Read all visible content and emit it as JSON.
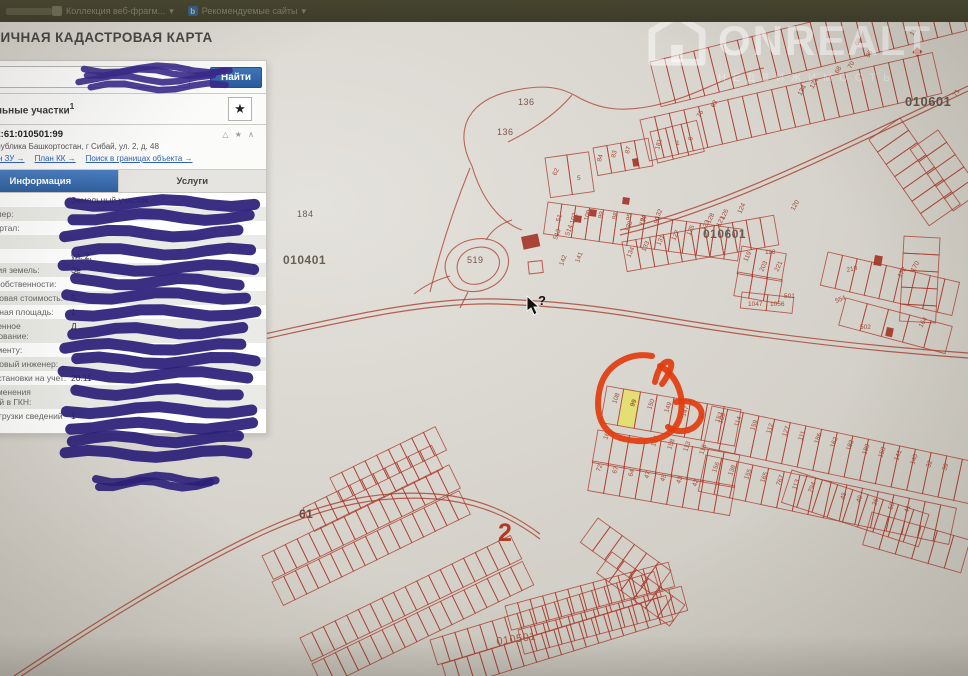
{
  "browser_bar": {
    "item1": "Коллекция веб-фрагм...",
    "item1_arrow": "▾",
    "item2": "Рекомендуемые сайты",
    "item2_arrow": "▾",
    "b_icon": "b"
  },
  "header": {
    "title": "ПУБЛИЧНАЯ КАДАСТРОВАЯ КАРТА"
  },
  "search": {
    "find_button": "Найти",
    "clear_icon": "×"
  },
  "results": {
    "group_label": "Земельные участки",
    "group_sup": "1",
    "star_icon": "★"
  },
  "parcel": {
    "index": "1.",
    "cadastral_number": "02:61:010501:99",
    "header_icons": "△ ★ ∧",
    "address": "Республика Башкортостан, г Сибай, ул. 2, д. 48",
    "links": [
      "План ЗУ →",
      "План КК →",
      "Поиск в границах объекта →"
    ],
    "tabs": {
      "info": "Информация",
      "services": "Услуги"
    },
    "fields": [
      {
        "label": "Тип:",
        "value": "Земельный участок"
      },
      {
        "label": "Кад. номер:",
        "value": ""
      },
      {
        "label": "Кад. квартал:",
        "value": ""
      },
      {
        "label": "Статус:",
        "value": ""
      },
      {
        "label": "Адрес:",
        "value": "ул. 2,"
      },
      {
        "label": "Категория земель:",
        "value": "Зе"
      },
      {
        "label": "Форма собственности:",
        "value": ""
      },
      {
        "label": "Кадастровая стоимость:",
        "value": "5"
      },
      {
        "label": "Уточненная площадь:",
        "value": "1"
      },
      {
        "label": "Разрешенное использование:",
        "value": "Д"
      },
      {
        "label": "по документу:",
        "value": ""
      },
      {
        "label": "Кадастровый инженер:",
        "value": ""
      },
      {
        "label": "Дата постановки на учет:",
        "value": "20.11"
      },
      {
        "label": "Дата изменения сведений в ГКН:",
        "value": ""
      },
      {
        "label": "Дата выгрузки сведений из ГКН:",
        "value": "1"
      }
    ]
  },
  "watermark": {
    "brand": "ONREALT",
    "sub": "НЕДВИЖИМОСТЬ"
  },
  "colors": {
    "accent_blue": "#2f5f9e",
    "pen_purple": "#2b1f78",
    "annotation_red": "#e23c0e",
    "highlight_yellow": "#e6e06b",
    "map_line_red": "#ac3a2c"
  },
  "map": {
    "cursor": {
      "x": 527,
      "y": 296,
      "glyph": "?"
    },
    "selected_parcel": {
      "number": "99"
    },
    "area_labels": [
      {
        "t": "010601",
        "x": 905,
        "y": 106,
        "s": 13,
        "c": "#5f564d",
        "b": 1
      },
      {
        "t": "010601",
        "x": 703,
        "y": 238,
        "s": 12,
        "c": "#6a5f55",
        "b": 1
      },
      {
        "t": "010401",
        "x": 283,
        "y": 264,
        "s": 12,
        "c": "#6a5f55",
        "b": 1
      },
      {
        "t": "184",
        "x": 297,
        "y": 217,
        "s": 9,
        "c": "#6a5f55"
      },
      {
        "t": "136",
        "x": 518,
        "y": 105,
        "s": 9,
        "c": "#7d5348"
      },
      {
        "t": "136",
        "x": 497,
        "y": 135,
        "s": 9,
        "c": "#7d5348"
      },
      {
        "t": "519",
        "x": 467,
        "y": 263,
        "s": 9,
        "c": "#7d5348"
      },
      {
        "t": "61",
        "x": 299,
        "y": 518,
        "s": 12,
        "c": "#6e4a3e",
        "b": 1
      },
      {
        "t": "2",
        "x": 498,
        "y": 541,
        "s": 25,
        "c": "#b03a24",
        "b": 1
      },
      {
        "t": "010501",
        "x": 497,
        "y": 645,
        "s": 11,
        "c": "#a85a43",
        "r": -8
      }
    ],
    "rows": [
      {
        "x": 650,
        "y": 62,
        "a": -14,
        "n": 21,
        "w": 15,
        "h": 46
      },
      {
        "x": 640,
        "y": 120,
        "a": -13,
        "n": 20,
        "w": 15,
        "h": 42
      },
      {
        "x": 593,
        "y": 148,
        "a": -10,
        "n": 4,
        "w": 14,
        "h": 28
      },
      {
        "x": 650,
        "y": 132,
        "a": -14,
        "n": 3,
        "w": 16,
        "h": 32
      },
      {
        "x": 548,
        "y": 202,
        "a": 8,
        "n": 14,
        "w": 14,
        "h": 32
      },
      {
        "x": 622,
        "y": 242,
        "a": -10,
        "n": 11,
        "w": 14,
        "h": 30
      },
      {
        "x": 742,
        "y": 246,
        "a": 10,
        "n": 3,
        "w": 15,
        "h": 28
      },
      {
        "x": 738,
        "y": 272,
        "a": 10,
        "n": 3,
        "w": 15,
        "h": 24
      },
      {
        "x": 828,
        "y": 252,
        "a": 13,
        "n": 9,
        "w": 15,
        "h": 34
      },
      {
        "x": 846,
        "y": 298,
        "a": 15,
        "n": 5,
        "w": 22,
        "h": 28
      },
      {
        "x": 940,
        "y": 238,
        "a": 93,
        "n": 5,
        "w": 17,
        "h": 36
      },
      {
        "x": 900,
        "y": 118,
        "a": 55,
        "n": 7,
        "w": 15,
        "h": 38
      },
      {
        "x": 938,
        "y": 130,
        "a": 55,
        "n": 5,
        "w": 15,
        "h": 34
      },
      {
        "x": 742,
        "y": 292,
        "a": 6,
        "n": 2,
        "w": 26,
        "h": 16
      },
      {
        "x": 607,
        "y": 386,
        "a": 10,
        "n": 8,
        "w": 17,
        "h": 37,
        "hl": 1
      },
      {
        "x": 598,
        "y": 430,
        "a": 10,
        "n": 9,
        "w": 16,
        "h": 33
      },
      {
        "x": 593,
        "y": 461,
        "a": 10,
        "n": 9,
        "w": 16,
        "h": 30
      },
      {
        "x": 712,
        "y": 406,
        "a": 12,
        "n": 17,
        "w": 16,
        "h": 42
      },
      {
        "x": 706,
        "y": 455,
        "a": 12,
        "n": 16,
        "w": 16,
        "h": 37
      },
      {
        "x": 598,
        "y": 518,
        "a": 36,
        "n": 6,
        "w": 15,
        "h": 30
      },
      {
        "x": 612,
        "y": 552,
        "a": 36,
        "n": 6,
        "w": 15,
        "h": 26
      },
      {
        "x": 792,
        "y": 470,
        "a": 18,
        "n": 9,
        "w": 16,
        "h": 34
      },
      {
        "x": 872,
        "y": 512,
        "a": 16,
        "n": 6,
        "w": 17,
        "h": 34
      },
      {
        "x": 330,
        "y": 478,
        "a": -26,
        "n": 9,
        "w": 13,
        "h": 26
      },
      {
        "x": 303,
        "y": 508,
        "a": -26,
        "n": 11,
        "w": 13,
        "h": 26
      },
      {
        "x": 262,
        "y": 556,
        "a": -26,
        "n": 16,
        "w": 13,
        "h": 26
      },
      {
        "x": 272,
        "y": 582,
        "a": -26,
        "n": 16,
        "w": 13,
        "h": 26
      },
      {
        "x": 300,
        "y": 638,
        "a": -26,
        "n": 18,
        "w": 13,
        "h": 26
      },
      {
        "x": 312,
        "y": 664,
        "a": -26,
        "n": 18,
        "w": 13,
        "h": 26
      },
      {
        "x": 430,
        "y": 640,
        "a": -17,
        "n": 18,
        "w": 13,
        "h": 26
      },
      {
        "x": 442,
        "y": 664,
        "a": -17,
        "n": 18,
        "w": 13,
        "h": 26
      },
      {
        "x": 505,
        "y": 606,
        "a": -15,
        "n": 13,
        "w": 13,
        "h": 25
      },
      {
        "x": 518,
        "y": 630,
        "a": -15,
        "n": 13,
        "w": 13,
        "h": 25
      },
      {
        "x": 545,
        "y": 158,
        "a": -8,
        "n": 2,
        "w": 22,
        "h": 40
      }
    ],
    "roads": [
      {
        "d": "M 246,338 C 330,320 420,297 498,299 C 560,301 606,307 664,317 C 770,335 868,346 968,353",
        "off": 5
      },
      {
        "d": "M 620,230 C 720,206 820,156 968,86",
        "off": 5
      },
      {
        "d": "M 14,676 C 95,622 185,566 262,530 C 330,499 382,490 436,494 C 480,498 512,513 540,534",
        "off": 5
      }
    ],
    "boundaries": [
      "M 472,166 C 452,128 470,98 516,90 C 546,84 562,88 576,96 C 600,110 622,112 652,106 C 700,96 722,76 764,68",
      "M 508,142 C 532,130 556,114 572,95",
      "M 472,166 C 482,200 500,222 522,230",
      "M 430,292 C 440,250 455,205 470,168",
      "M 452,284 C 438,268 446,246 470,240 C 494,234 512,248 508,266 C 504,284 484,294 466,291 C 459,290 455,288 452,284",
      "M 462,280 C 452,268 458,252 474,248 C 490,244 502,254 499,266 C 496,278 482,286 470,284 C 466,283 464,282 462,280",
      "M 468,292 L 460,308",
      "M 486,240 C 492,230 500,224 512,220",
      "M 450,276 C 436,280 424,286 414,294"
    ],
    "buildings": [
      {
        "x": 521,
        "y": 237,
        "w": 17,
        "h": 13,
        "r": -12
      },
      {
        "x": 575,
        "y": 215,
        "w": 7,
        "h": 7,
        "r": 8
      },
      {
        "x": 590,
        "y": 209,
        "w": 7,
        "h": 7,
        "r": 8
      },
      {
        "x": 623,
        "y": 197,
        "w": 7,
        "h": 7,
        "r": 8
      },
      {
        "x": 632,
        "y": 159,
        "w": 6,
        "h": 8,
        "r": -10
      },
      {
        "x": 875,
        "y": 255,
        "w": 8,
        "h": 10,
        "r": 10
      },
      {
        "x": 887,
        "y": 327,
        "w": 7,
        "h": 9,
        "r": 12
      },
      {
        "x": 917,
        "y": 47,
        "w": 7,
        "h": 7,
        "r": 40
      }
    ],
    "squares": [
      {
        "x": 528,
        "y": 262,
        "w": 14,
        "h": 12,
        "r": -6
      }
    ],
    "parcel_labels": [
      {
        "t": "108",
        "x": 616,
        "y": 404,
        "r": -70
      },
      {
        "t": "150",
        "x": 651,
        "y": 410,
        "r": -70
      },
      {
        "t": "149",
        "x": 668,
        "y": 413,
        "r": -70
      },
      {
        "t": "147",
        "x": 685,
        "y": 417,
        "r": -70
      },
      {
        "t": "97",
        "x": 702,
        "y": 420,
        "r": -70
      },
      {
        "t": "153",
        "x": 719,
        "y": 423,
        "r": -70
      },
      {
        "t": "16",
        "x": 607,
        "y": 440,
        "r": -70
      },
      {
        "t": "11",
        "x": 623,
        "y": 442,
        "r": -70
      },
      {
        "t": "157",
        "x": 655,
        "y": 447,
        "r": -70
      },
      {
        "t": "158",
        "x": 671,
        "y": 450,
        "r": -70
      },
      {
        "t": "113",
        "x": 687,
        "y": 452,
        "r": -70
      },
      {
        "t": "116",
        "x": 703,
        "y": 455,
        "r": -70
      },
      {
        "t": "72",
        "x": 600,
        "y": 472,
        "r": -70
      },
      {
        "t": "67",
        "x": 616,
        "y": 474,
        "r": -70
      },
      {
        "t": "64",
        "x": 632,
        "y": 477,
        "r": -70
      },
      {
        "t": "47",
        "x": 648,
        "y": 479,
        "r": -70
      },
      {
        "t": "45",
        "x": 664,
        "y": 482,
        "r": -70
      },
      {
        "t": "43",
        "x": 680,
        "y": 484,
        "r": -70
      },
      {
        "t": "42",
        "x": 696,
        "y": 487,
        "r": -70
      },
      {
        "t": "109",
        "x": 722,
        "y": 424,
        "r": -70
      },
      {
        "t": "114",
        "x": 738,
        "y": 427,
        "r": -70
      },
      {
        "t": "159",
        "x": 754,
        "y": 431,
        "r": -70
      },
      {
        "t": "112",
        "x": 770,
        "y": 434,
        "r": -70
      },
      {
        "t": "127",
        "x": 786,
        "y": 437,
        "r": -70
      },
      {
        "t": "111",
        "x": 802,
        "y": 441,
        "r": -70
      },
      {
        "t": "186",
        "x": 818,
        "y": 444,
        "r": -70
      },
      {
        "t": "162",
        "x": 834,
        "y": 448,
        "r": -70
      },
      {
        "t": "183",
        "x": 850,
        "y": 451,
        "r": -70
      },
      {
        "t": "180",
        "x": 866,
        "y": 455,
        "r": -70
      },
      {
        "t": "158",
        "x": 882,
        "y": 458,
        "r": -70
      },
      {
        "t": "141",
        "x": 898,
        "y": 461,
        "r": -70
      },
      {
        "t": "140",
        "x": 914,
        "y": 465,
        "r": -70
      },
      {
        "t": "32",
        "x": 930,
        "y": 468,
        "r": -70
      },
      {
        "t": "39",
        "x": 946,
        "y": 471,
        "r": -70
      },
      {
        "t": "156",
        "x": 716,
        "y": 473,
        "r": -70
      },
      {
        "t": "138",
        "x": 732,
        "y": 476,
        "r": -70
      },
      {
        "t": "155",
        "x": 748,
        "y": 480,
        "r": -70
      },
      {
        "t": "165",
        "x": 764,
        "y": 483,
        "r": -70
      },
      {
        "t": "767",
        "x": 780,
        "y": 486,
        "r": -70
      },
      {
        "t": "113",
        "x": 796,
        "y": 490,
        "r": -70
      },
      {
        "t": "794",
        "x": 812,
        "y": 493,
        "r": -70
      },
      {
        "t": "45",
        "x": 844,
        "y": 500,
        "r": -70
      },
      {
        "t": "49",
        "x": 860,
        "y": 503,
        "r": -70
      },
      {
        "t": "26",
        "x": 876,
        "y": 506,
        "r": -70
      },
      {
        "t": "50",
        "x": 892,
        "y": 510,
        "r": -70
      },
      {
        "t": "41",
        "x": 908,
        "y": 513,
        "r": -70
      },
      {
        "t": "51",
        "x": 560,
        "y": 222,
        "r": -75
      },
      {
        "t": "102",
        "x": 574,
        "y": 224,
        "r": -75
      },
      {
        "t": "100",
        "x": 588,
        "y": 221,
        "r": -75
      },
      {
        "t": "99",
        "x": 602,
        "y": 219,
        "r": -75
      },
      {
        "t": "98",
        "x": 616,
        "y": 220,
        "r": -75
      },
      {
        "t": "95",
        "x": 630,
        "y": 221,
        "r": -75
      },
      {
        "t": "94",
        "x": 644,
        "y": 222,
        "r": -75
      },
      {
        "t": "90",
        "x": 658,
        "y": 224,
        "r": -75
      },
      {
        "t": "84",
        "x": 601,
        "y": 162,
        "r": -75
      },
      {
        "t": "83",
        "x": 615,
        "y": 158,
        "r": -75
      },
      {
        "t": "87",
        "x": 629,
        "y": 154,
        "r": -75
      },
      {
        "t": "181",
        "x": 659,
        "y": 150,
        "r": -75
      },
      {
        "t": "1",
        "x": 676,
        "y": 145,
        "r": 0
      },
      {
        "t": "6",
        "x": 692,
        "y": 141,
        "r": -75
      },
      {
        "t": "62",
        "x": 556,
        "y": 176,
        "r": -65
      },
      {
        "t": "5",
        "x": 577,
        "y": 180,
        "r": 0
      },
      {
        "t": "134",
        "x": 630,
        "y": 258,
        "r": -65
      },
      {
        "t": "133",
        "x": 645,
        "y": 252,
        "r": -65
      },
      {
        "t": "131",
        "x": 660,
        "y": 246,
        "r": -65
      },
      {
        "t": "127",
        "x": 675,
        "y": 241,
        "r": -65
      },
      {
        "t": "125",
        "x": 690,
        "y": 236,
        "r": -65
      },
      {
        "t": "123",
        "x": 705,
        "y": 231,
        "r": -65
      },
      {
        "t": "121",
        "x": 720,
        "y": 227,
        "r": -65
      },
      {
        "t": "119",
        "x": 747,
        "y": 262,
        "r": -65
      },
      {
        "t": "138",
        "x": 628,
        "y": 232,
        "r": -65
      },
      {
        "t": "137",
        "x": 643,
        "y": 226,
        "r": -65
      },
      {
        "t": "132",
        "x": 658,
        "y": 220,
        "r": -65
      },
      {
        "t": "128",
        "x": 710,
        "y": 224,
        "r": -65
      },
      {
        "t": "126",
        "x": 724,
        "y": 220,
        "r": -65
      },
      {
        "t": "124",
        "x": 741,
        "y": 214,
        "r": -65
      },
      {
        "t": "120",
        "x": 794,
        "y": 211,
        "r": -60
      },
      {
        "t": "118",
        "x": 765,
        "y": 254,
        "r": 0
      },
      {
        "t": "221",
        "x": 778,
        "y": 272,
        "r": -65
      },
      {
        "t": "203",
        "x": 763,
        "y": 272,
        "r": -65
      },
      {
        "t": "501",
        "x": 784,
        "y": 298,
        "r": 0
      },
      {
        "t": "1047",
        "x": 748,
        "y": 306,
        "r": 0
      },
      {
        "t": "1056",
        "x": 770,
        "y": 306,
        "r": 0
      },
      {
        "t": "513",
        "x": 557,
        "y": 240,
        "r": -70
      },
      {
        "t": "514",
        "x": 569,
        "y": 236,
        "r": -70
      },
      {
        "t": "142",
        "x": 563,
        "y": 266,
        "r": -70
      },
      {
        "t": "141",
        "x": 579,
        "y": 263,
        "r": -70
      },
      {
        "t": "210",
        "x": 847,
        "y": 272,
        "r": -12
      },
      {
        "t": "172",
        "x": 901,
        "y": 278,
        "r": -60
      },
      {
        "t": "170",
        "x": 914,
        "y": 272,
        "r": -60
      },
      {
        "t": "164",
        "x": 922,
        "y": 328,
        "r": -60
      },
      {
        "t": "554",
        "x": 836,
        "y": 303,
        "r": -20
      },
      {
        "t": "502",
        "x": 860,
        "y": 329,
        "r": 0
      },
      {
        "t": "69",
        "x": 858,
        "y": 46,
        "r": -60
      },
      {
        "t": "96",
        "x": 869,
        "y": 58,
        "r": -60
      },
      {
        "t": "70",
        "x": 851,
        "y": 69,
        "r": -60
      },
      {
        "t": "68",
        "x": 838,
        "y": 74,
        "r": -60
      },
      {
        "t": "124",
        "x": 813,
        "y": 89,
        "r": -60
      },
      {
        "t": "134",
        "x": 801,
        "y": 96,
        "r": -60
      },
      {
        "t": "11",
        "x": 913,
        "y": 36,
        "r": -60
      },
      {
        "t": "73",
        "x": 939,
        "y": 23,
        "r": -60
      },
      {
        "t": "71",
        "x": 956,
        "y": 97,
        "r": -60
      },
      {
        "t": "76",
        "x": 700,
        "y": 118,
        "r": -60
      },
      {
        "t": "63",
        "x": 714,
        "y": 108,
        "r": -60
      }
    ]
  },
  "pen": {
    "circle_paths": [
      "M 652,356 C 630,352 606,364 600,388 C 594,414 602,434 624,439 C 650,445 674,438 680,417 C 685,398 678,376 660,366",
      "M 655,382 C 658,368 664,360 670,362 C 674,364 668,376 662,384",
      "M 676,402 C 694,398 706,408 700,420 C 694,432 678,434 668,427"
    ],
    "blob": {
      "x0": 70,
      "x1": 247,
      "y": 203,
      "step": 15.8,
      "n": 17,
      "w": 11
    },
    "search_scribble": {
      "x0": 84,
      "x1": 222,
      "y": 69,
      "step": 5.5,
      "n": 4,
      "w": 6.5
    },
    "tail": {
      "x0": 96,
      "x1": 208,
      "y": 479,
      "step": 7,
      "n": 2,
      "w": 8
    }
  }
}
